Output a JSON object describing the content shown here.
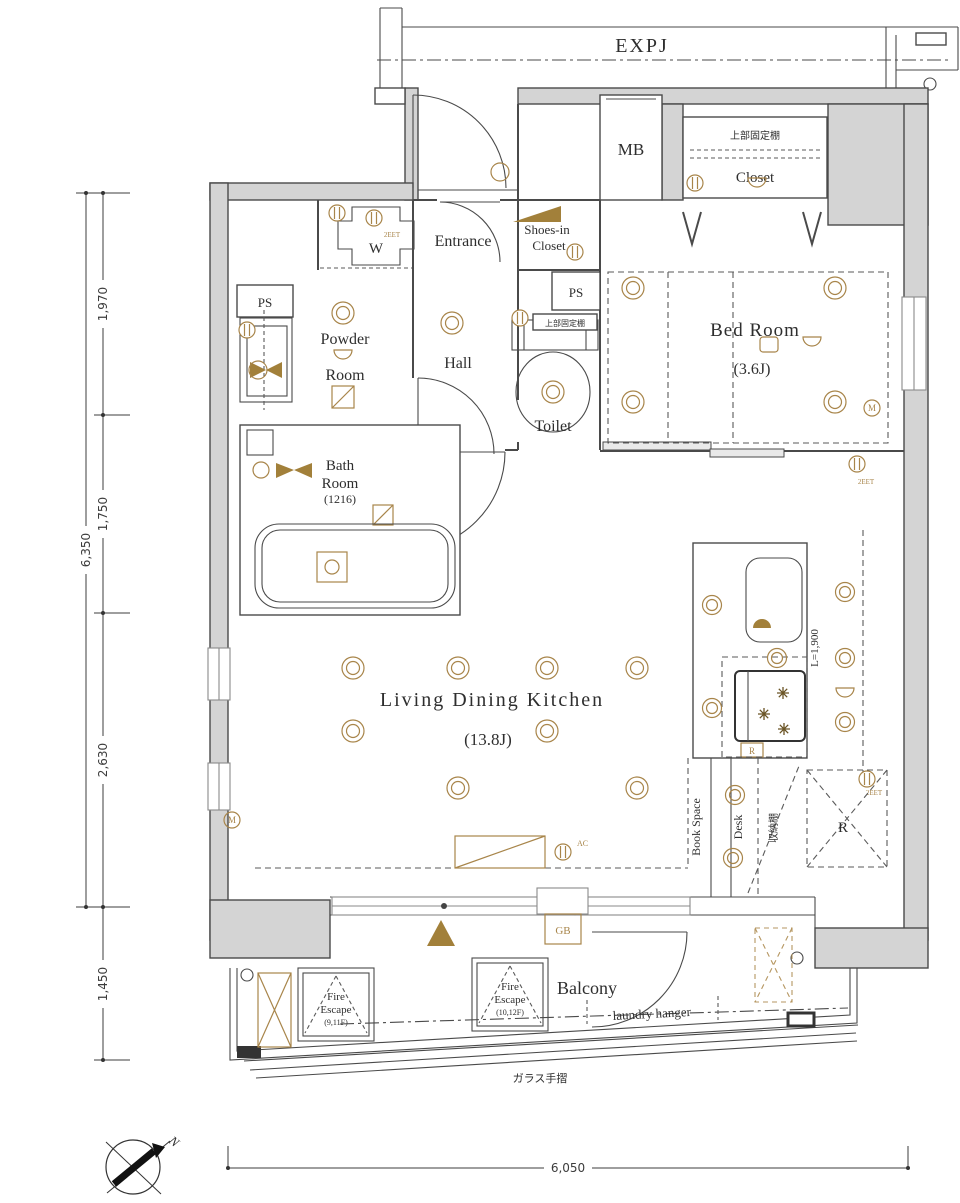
{
  "colors": {
    "wall_fill": "#d4d4d4",
    "line": "#4a4a4a",
    "accent_tan": "#a8854a",
    "text": "#2e2e2e"
  },
  "header": {
    "expansion_joint": "EXPJ"
  },
  "rooms": {
    "meter_box": "MB",
    "closet_upper_shelf": "上部固定棚",
    "closet": "Closet",
    "entrance": "Entrance",
    "shoes_closet_line1": "Shoes-in",
    "shoes_closet_line2": "Closet",
    "washer": "W",
    "pipe_space_left": "PS",
    "pipe_space_right": "PS",
    "powder_line1": "Powder",
    "powder_line2": "Room",
    "hall": "Hall",
    "toilet": "Toilet",
    "toilet_upper_shelf": "上部固定棚",
    "bedroom": "Bed Room",
    "bedroom_size": "(3.6J)",
    "bath_line1": "Bath",
    "bath_line2": "Room",
    "bath_size": "(1216)",
    "ldk": "Living Dining Kitchen",
    "ldk_size": "(13.8J)",
    "balcony": "Balcony"
  },
  "annotations": {
    "kitchen_counter_length": "L=1,900",
    "book_space": "Book Space",
    "desk": "Desk",
    "storage_shelf": "収納棚",
    "refrigerator": "R",
    "range": "R",
    "fire_escape1_line1": "Fire",
    "fire_escape1_line2": "Escape",
    "fire_escape1_floors": "(9,11F)",
    "fire_escape2_line1": "Fire",
    "fire_escape2_line2": "Escape",
    "fire_escape2_floors": "(10,12F)",
    "laundry_hanger": "laundry hanger",
    "glass_handrail": "ガラス手摺",
    "gas_box": "GB",
    "air_conditioner": "AC",
    "outlet": "2EET",
    "meter": "M",
    "north": "N"
  },
  "dimensions": {
    "left_total": "6,350",
    "left_seg1": "1,970",
    "left_seg2": "1,750",
    "left_seg3": "2,630",
    "left_seg4": "1,450",
    "bottom_total": "6,050"
  }
}
